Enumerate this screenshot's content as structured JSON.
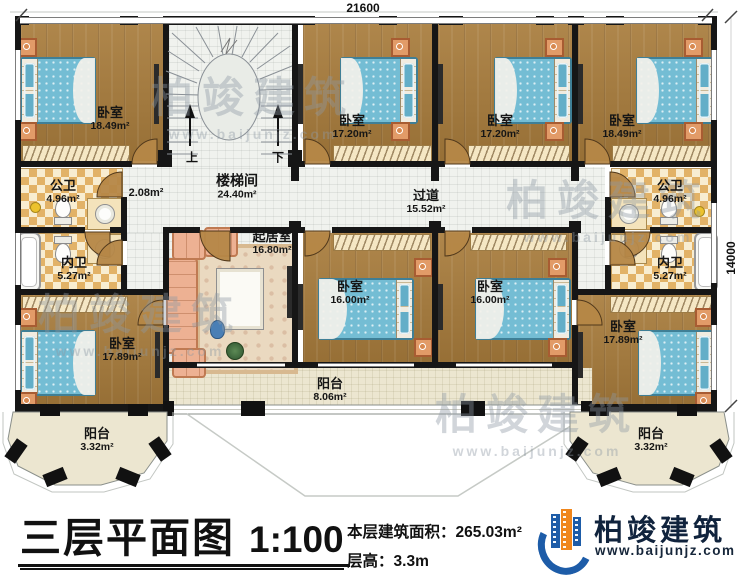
{
  "dims": {
    "top": "21600",
    "right": "14000"
  },
  "watermark": {
    "brand": "柏竣建筑",
    "url": "www.baijunjz.com"
  },
  "plan": {
    "stairwell": {
      "label": "楼梯间",
      "area": "24.40m²",
      "up": "上",
      "down": "下",
      "landing_area": "2.08m²"
    },
    "corridor": {
      "label": "过道",
      "area": "15.52m²"
    },
    "living": {
      "label": "起居室",
      "area": "16.80m²"
    },
    "bedroom_tl": {
      "label": "卧室",
      "area": "18.49m²"
    },
    "bedroom_t2": {
      "label": "卧室",
      "area": "17.20m²"
    },
    "bedroom_t3": {
      "label": "卧室",
      "area": "17.20m²"
    },
    "bedroom_tr": {
      "label": "卧室",
      "area": "18.49m²"
    },
    "bedroom_m1": {
      "label": "卧室",
      "area": "16.00m²"
    },
    "bedroom_m2": {
      "label": "卧室",
      "area": "16.00m²"
    },
    "bedroom_bl": {
      "label": "卧室",
      "area": "17.89m²"
    },
    "bedroom_br": {
      "label": "卧室",
      "area": "17.89m²"
    },
    "bath_public_left": {
      "label": "公卫",
      "area": "4.96m²"
    },
    "bath_private_left": {
      "label": "内卫",
      "area": "5.27m²"
    },
    "bath_public_right": {
      "label": "公卫",
      "area": "4.96m²"
    },
    "bath_private_right": {
      "label": "内卫",
      "area": "5.27m²"
    },
    "balcony_center": {
      "label": "阳台",
      "area": "8.06m²"
    },
    "balcony_bl": {
      "label": "阳台",
      "area": "3.32m²"
    },
    "balcony_br": {
      "label": "阳台",
      "area": "3.32m²"
    }
  },
  "footer": {
    "title": "三层平面图",
    "scale": "1:100",
    "area_label": "本层建筑面积：",
    "area_value": "265.03m²",
    "height_label": "层高：",
    "height_value": "3.3m"
  },
  "logo": {
    "brand": "柏竣建筑",
    "url": "www.baijunjz.com"
  }
}
